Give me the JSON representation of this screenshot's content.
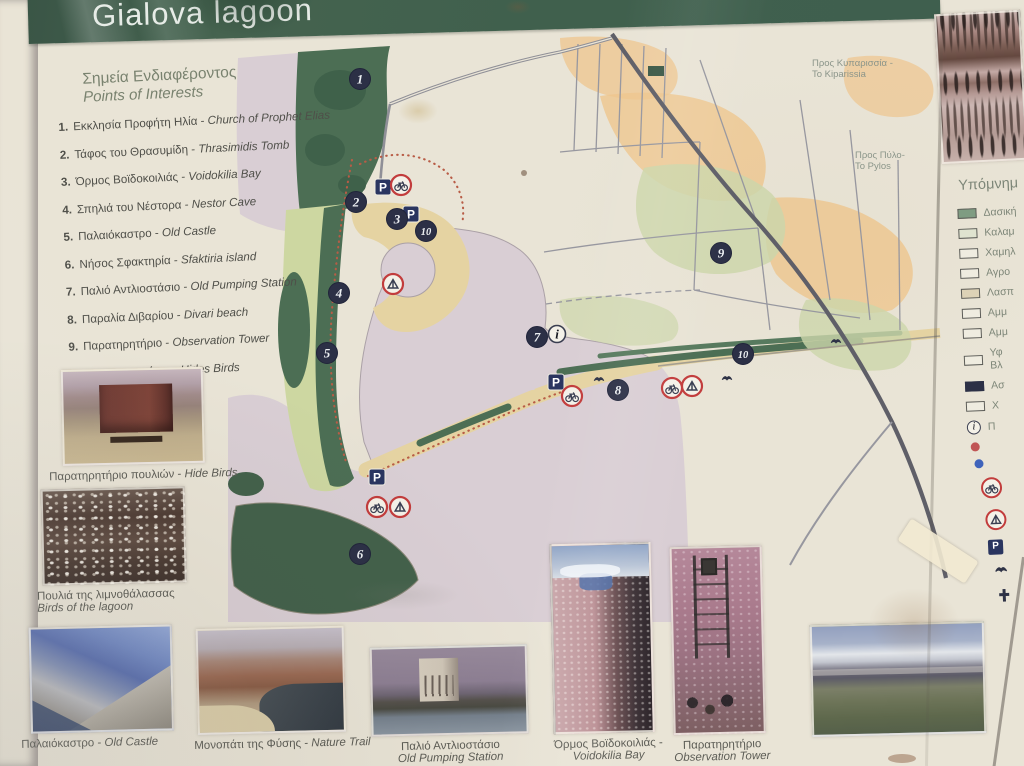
{
  "header": {
    "title": "Gialova lagoon"
  },
  "poi": {
    "heading_el": "Σημεία Ενδιαφέροντος",
    "heading_en": "Points of Interests",
    "items": [
      {
        "num": "1.",
        "el": "Εκκλησία Προφήτη Ηλία",
        "en": "Church of Prophet Elias"
      },
      {
        "num": "2.",
        "el": "Τάφος του Θρασυμίδη",
        "en": "Thrasimidis Tomb"
      },
      {
        "num": "3.",
        "el": "Όρμος Βοϊδοκοιλιάς",
        "en": "Voidokilia Bay"
      },
      {
        "num": "4.",
        "el": "Σπηλιά του Νέστορα",
        "en": "Nestor Cave"
      },
      {
        "num": "5.",
        "el": "Παλαιόκαστρο",
        "en": "Old Castle"
      },
      {
        "num": "6.",
        "el": "Νήσος Σφακτηρία",
        "en": "Sfaktiria island"
      },
      {
        "num": "7.",
        "el": "Παλιό Αντλιοστάσιο",
        "en": "Old Pumping Station"
      },
      {
        "num": "8.",
        "el": "Παραλία Διβαρίου",
        "en": "Divari beach"
      },
      {
        "num": "9.",
        "el": "Παρατηρητήριο",
        "en": "Observation Tower"
      },
      {
        "num": "10.",
        "el": "Παρατηρητήρια",
        "en": "Hides Birds"
      }
    ]
  },
  "map": {
    "labels": [
      {
        "x": 812,
        "y": 66,
        "lines": [
          "Προς Κυπαρισσία -",
          "To Kiparissia"
        ]
      },
      {
        "x": 855,
        "y": 158,
        "lines": [
          "Προς Πύλο-",
          "To Pylos"
        ]
      }
    ],
    "markers": [
      {
        "n": "1",
        "x": 360,
        "y": 79
      },
      {
        "n": "2",
        "x": 356,
        "y": 202
      },
      {
        "n": "3",
        "x": 397,
        "y": 219
      },
      {
        "n": "10",
        "x": 426,
        "y": 231
      },
      {
        "n": "4",
        "x": 339,
        "y": 293
      },
      {
        "n": "5",
        "x": 327,
        "y": 353
      },
      {
        "n": "6",
        "x": 360,
        "y": 554
      },
      {
        "n": "7",
        "x": 537,
        "y": 337
      },
      {
        "n": "8",
        "x": 618,
        "y": 390
      },
      {
        "n": "9",
        "x": 721,
        "y": 253
      },
      {
        "n": "10",
        "x": 743,
        "y": 354
      }
    ],
    "info_point": {
      "x": 557,
      "y": 334,
      "glyph": "i"
    },
    "parking": [
      {
        "x": 383,
        "y": 187
      },
      {
        "x": 411,
        "y": 214
      },
      {
        "x": 556,
        "y": 382
      },
      {
        "x": 377,
        "y": 477
      }
    ],
    "rings": [
      {
        "kind": "bike",
        "x": 401,
        "y": 185
      },
      {
        "kind": "tent",
        "x": 393,
        "y": 284
      },
      {
        "kind": "bike",
        "x": 572,
        "y": 396
      },
      {
        "kind": "bike",
        "x": 672,
        "y": 388
      },
      {
        "kind": "tent",
        "x": 692,
        "y": 386
      },
      {
        "kind": "bike",
        "x": 377,
        "y": 507
      },
      {
        "kind": "tent",
        "x": 400,
        "y": 507
      }
    ],
    "birds": [
      {
        "x": 599,
        "y": 380
      },
      {
        "x": 727,
        "y": 379
      },
      {
        "x": 836,
        "y": 342
      }
    ],
    "parking_glyph": "P"
  },
  "legend": {
    "heading": "Υπόμνημ",
    "items": [
      {
        "type": "swatch",
        "color": "#7f9c82",
        "label": "Δασική"
      },
      {
        "type": "swatch",
        "color": "#dfe3cf",
        "label": "Καλαμ"
      },
      {
        "type": "swatch",
        "color": "#efece0",
        "label": "Χαμηλ"
      },
      {
        "type": "swatch",
        "color": "#efece0",
        "label": "Αγρο"
      },
      {
        "type": "swatch",
        "color": "#ddd2b6",
        "label": "Λασπ"
      },
      {
        "type": "swatch",
        "color": "#efece0",
        "label": "Αμμ"
      },
      {
        "type": "swatch",
        "color": "#efece0",
        "label": "Αμμ"
      },
      {
        "type": "swatch",
        "color": "#efece0",
        "label": "Υφ",
        "label2": "Βλ"
      },
      {
        "type": "swatch",
        "color": "#2c3046",
        "label": "Ασ"
      },
      {
        "type": "swatch",
        "color": "#efece0",
        "label": "Χ"
      },
      {
        "type": "info",
        "label": "Π"
      },
      {
        "type": "dot",
        "color": "#c05555",
        "label": ""
      },
      {
        "type": "dot",
        "color": "#3f63bb",
        "label": ""
      },
      {
        "type": "ring-bike",
        "label": ""
      },
      {
        "type": "ring-tent",
        "label": ""
      },
      {
        "type": "parking",
        "label": ""
      },
      {
        "type": "bird",
        "label": ""
      },
      {
        "type": "cross",
        "label": ""
      }
    ]
  },
  "photos": {
    "hide_birds": {
      "el": "Παρατηρητήριο πουλιών -",
      "en": "Hide Birds"
    },
    "birds_lagoon": {
      "el": "Πουλιά της λιμνοθάλασσας",
      "en": "Birds of the lagoon"
    },
    "old_castle": {
      "el": "Παλαιόκαστρο -",
      "en": "Old Castle"
    },
    "nature_trail": {
      "el": "Μονοπάτι της Φύσης -",
      "en": "Nature Trail"
    },
    "pumping_station": {
      "el": "Παλιό Αντλιοστάσιο",
      "en": "Old Pumping Station"
    },
    "voidokilia": {
      "el": "Όρμος Βοϊδοκοιλιάς -",
      "en": "Voidokilia Bay"
    },
    "observation_tower": {
      "el": "Παρατηρητήριο",
      "en": "Observation Tower"
    }
  },
  "colors": {
    "header_green": "#42604f",
    "sign_cream": "#e9e4d6",
    "water_pink": "#d9ced4",
    "forest_dark": "#4c6e54",
    "scrub_light": "#cdd7a1",
    "sand_tan": "#e5d3a2",
    "field_orange": "#eec58d",
    "field_green": "#ccd6aa",
    "road_dark": "#5f5f68",
    "road_light": "#97979f",
    "trail_red": "#b85c46",
    "marker_navy": "#2c3046",
    "ring_red": "#c23c3c"
  }
}
